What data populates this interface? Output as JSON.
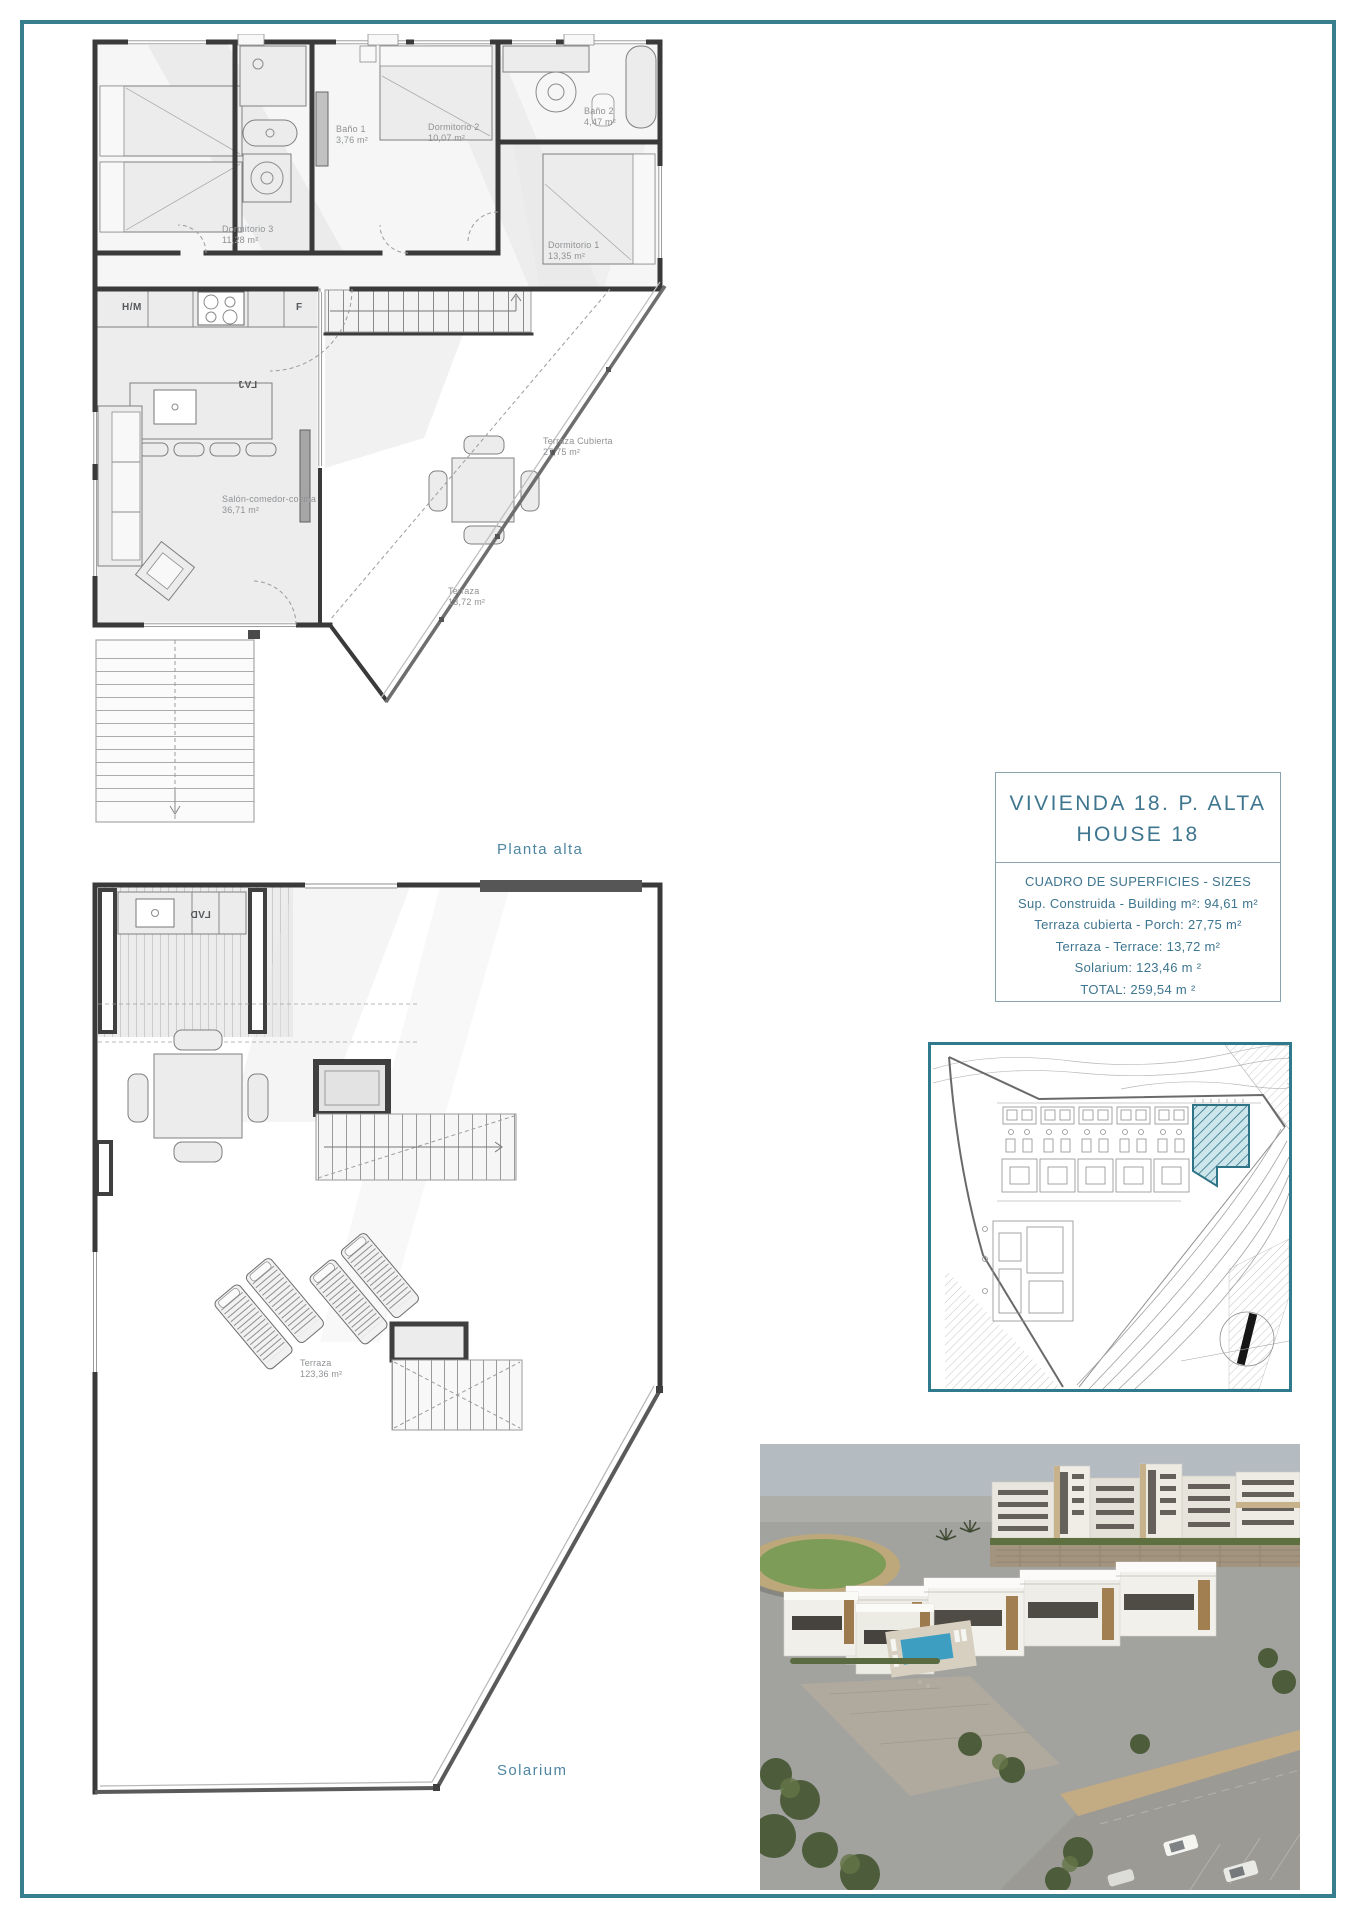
{
  "colors": {
    "frame": "#377f8e",
    "caption": "#4e86a2",
    "title": "#3e758f",
    "plot_highlight": "#2e7386",
    "pool": "#3d9ec2"
  },
  "planta_alta": {
    "caption": "Planta alta",
    "rooms": {
      "dormitorio3": {
        "name": "Dormitorio 3",
        "area": "11,28 m²"
      },
      "bano1": {
        "name": "Baño 1",
        "area": "3,76 m²"
      },
      "dormitorio2": {
        "name": "Dormitorio 2",
        "area": "10,07 m²"
      },
      "bano2": {
        "name": "Baño 2",
        "area": "4,47 m²"
      },
      "dormitorio1": {
        "name": "Dormitorio 1",
        "area": "13,35 m²"
      },
      "salon": {
        "name": "Salón-comedor-cocina",
        "area": "36,71 m²"
      },
      "terraza_cubierta": {
        "name": "Terraza Cubierta",
        "area": "27,75 m²"
      },
      "terraza": {
        "name": "Terraza",
        "area": "13,72 m²"
      }
    },
    "appliances": {
      "washer": "H/M",
      "fridge": "F",
      "dishwasher": "LVJ"
    }
  },
  "solarium": {
    "caption": "Solarium",
    "rooms": {
      "terraza": {
        "name": "Terraza",
        "area": "123,36 m²"
      }
    },
    "appliances": {
      "sink_unit": "LVD"
    }
  },
  "info_box": {
    "title_line1": "VIVIENDA 18. P. ALTA",
    "title_line2": "HOUSE 18",
    "header": "CUADRO DE SUPERFICIES  - SIZES",
    "rows": [
      "Sup. Construida  - Building m²: 94,61 m²",
      "Terraza cubierta  - Porch: 27,75 m²",
      "Terraza - Terrace: 13,72 m²",
      "Solarium:  123,46 m ²",
      "TOTAL:  259,54 m ²"
    ]
  }
}
